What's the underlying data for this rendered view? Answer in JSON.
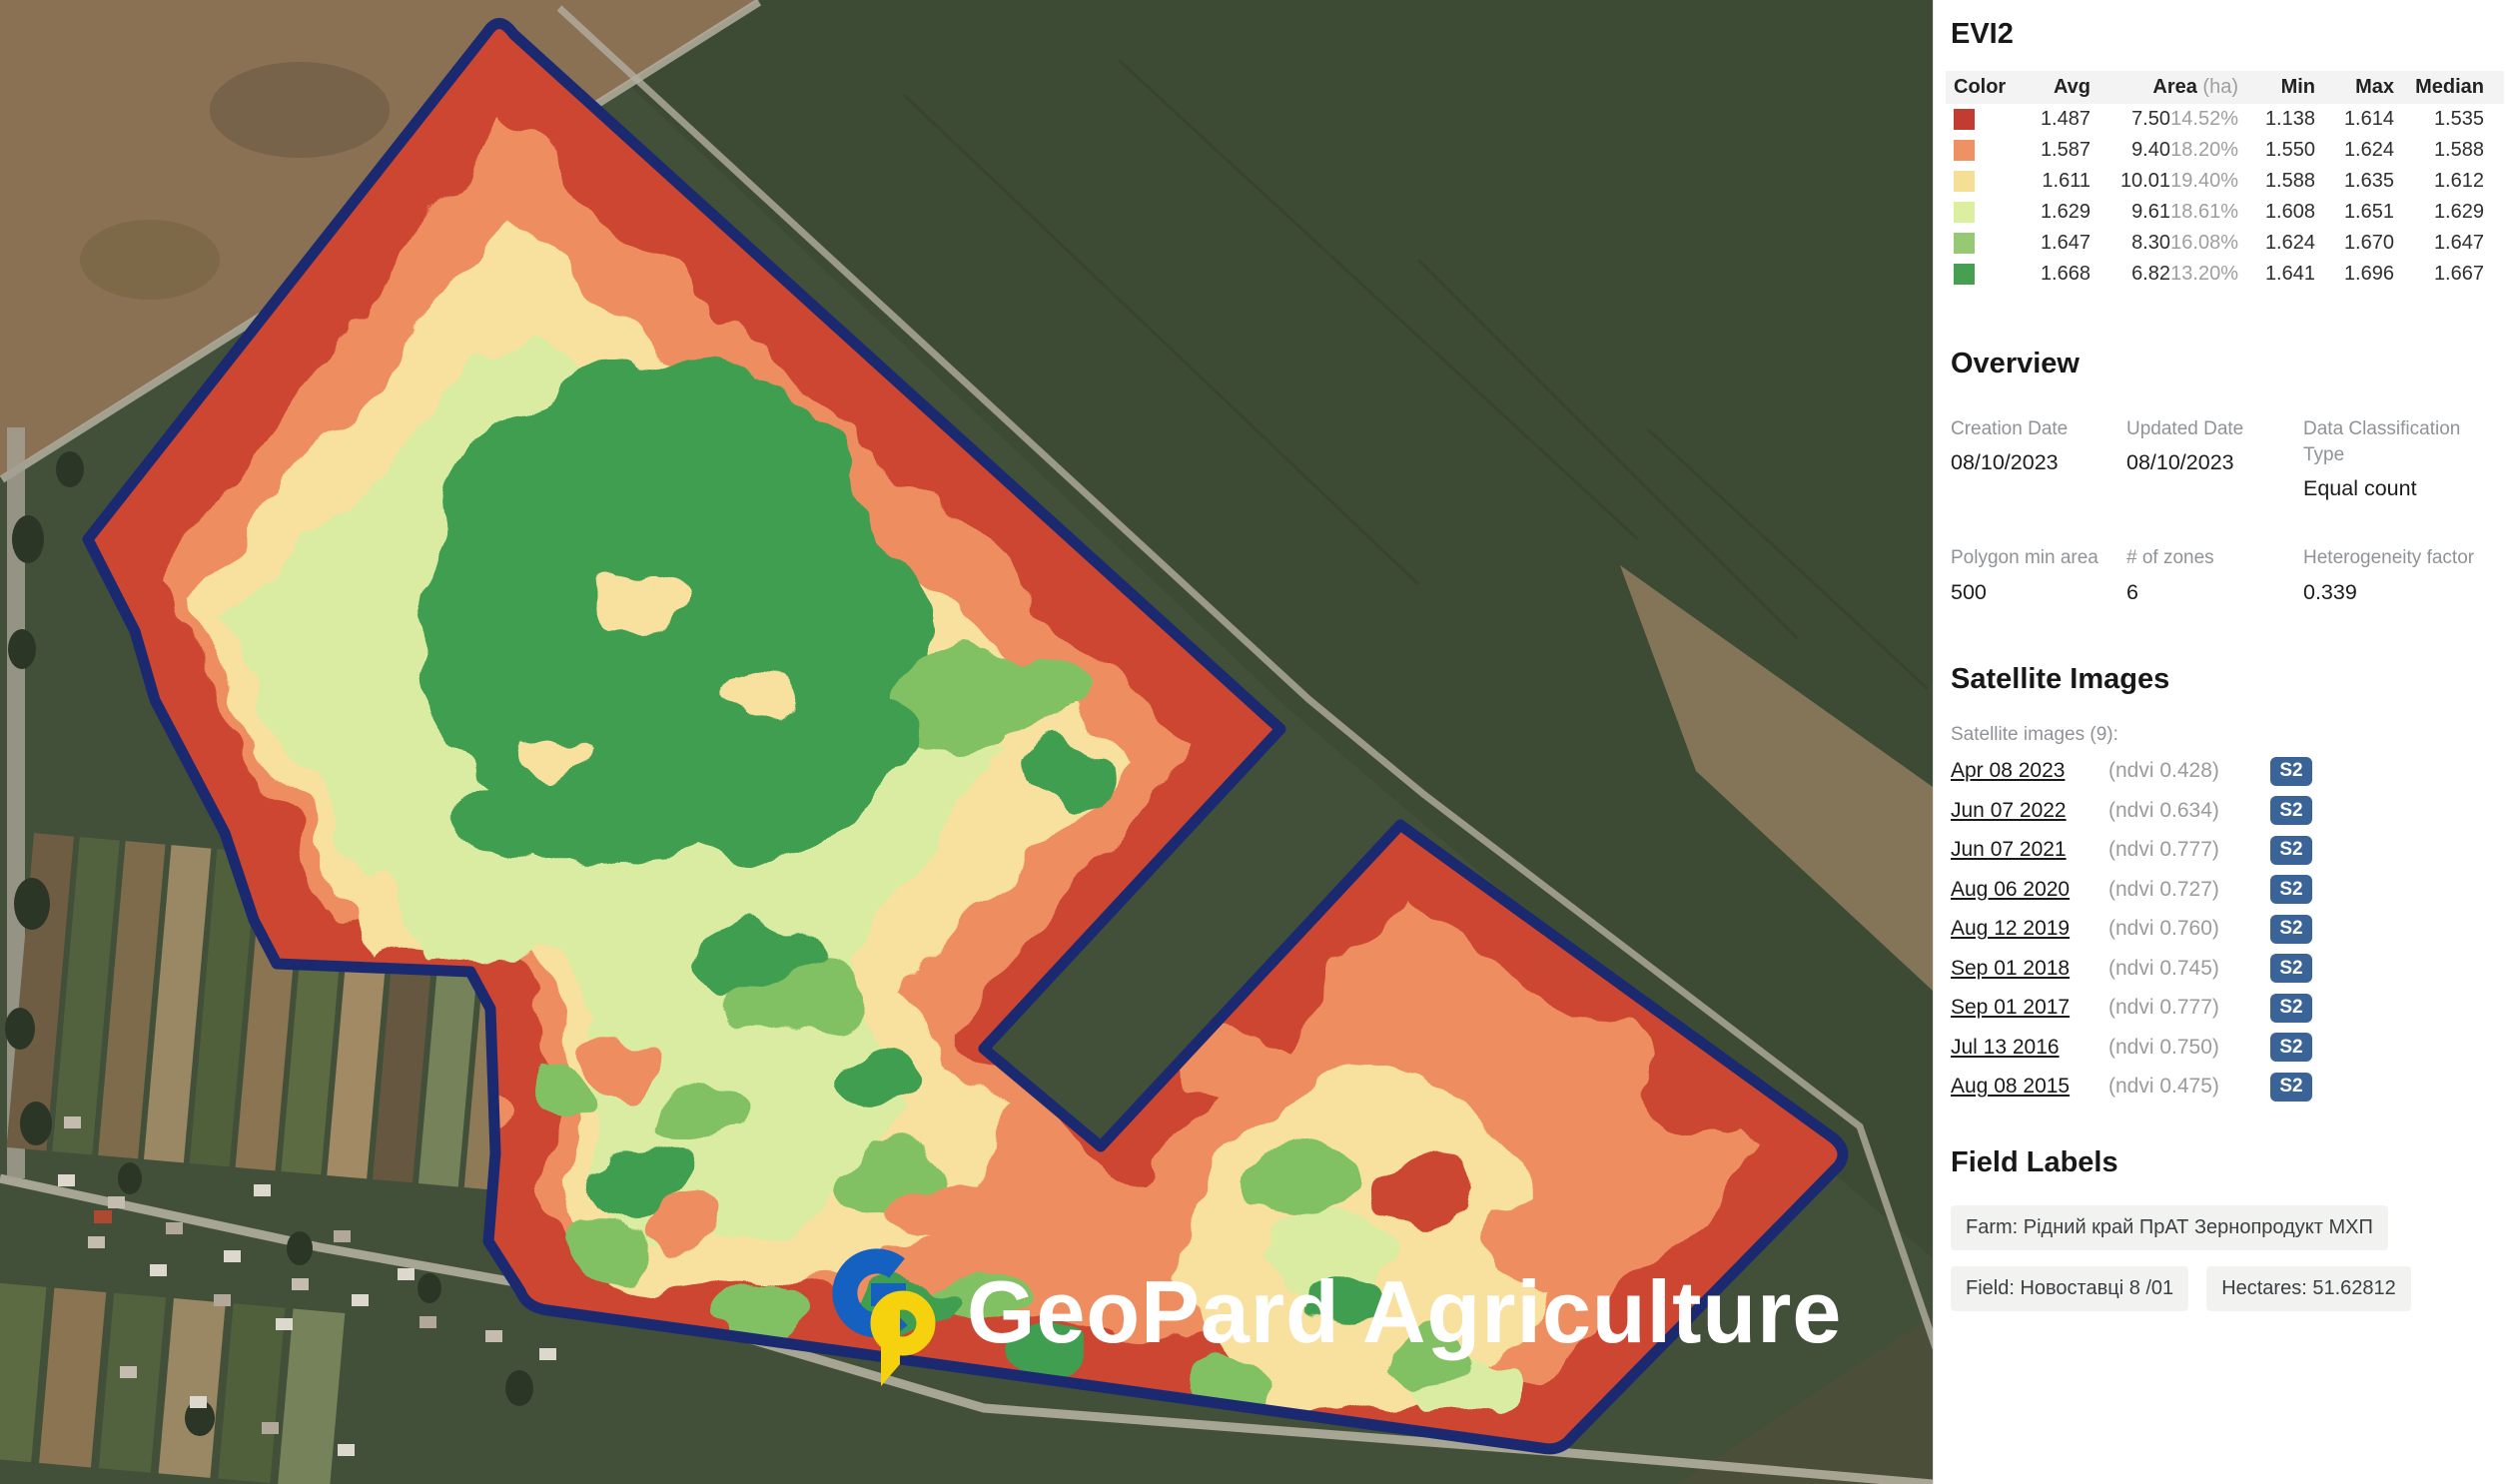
{
  "map": {
    "watermark_text": "GeoPard Agriculture",
    "logo_blue": "#1561c1",
    "logo_yellow": "#f6d20e",
    "field_outline_color": "#1b2a70"
  },
  "evi2": {
    "title": "EVI2",
    "columns": {
      "color": "Color",
      "avg": "Avg",
      "area": "Area",
      "area_unit": "(ha)",
      "min": "Min",
      "max": "Max",
      "median": "Median"
    },
    "rows": [
      {
        "color": "#c23c31",
        "avg": "1.487",
        "area": "7.50",
        "area_pct": "14.52%",
        "min": "1.138",
        "max": "1.614",
        "median": "1.535"
      },
      {
        "color": "#ef9263",
        "avg": "1.587",
        "area": "9.40",
        "area_pct": "18.20%",
        "min": "1.550",
        "max": "1.624",
        "median": "1.588"
      },
      {
        "color": "#f5df94",
        "avg": "1.611",
        "area": "10.01",
        "area_pct": "19.40%",
        "min": "1.588",
        "max": "1.635",
        "median": "1.612"
      },
      {
        "color": "#dcee9f",
        "avg": "1.629",
        "area": "9.61",
        "area_pct": "18.61%",
        "min": "1.608",
        "max": "1.651",
        "median": "1.629"
      },
      {
        "color": "#97c873",
        "avg": "1.647",
        "area": "8.30",
        "area_pct": "16.08%",
        "min": "1.624",
        "max": "1.670",
        "median": "1.647"
      },
      {
        "color": "#47a052",
        "avg": "1.668",
        "area": "6.82",
        "area_pct": "13.20%",
        "min": "1.641",
        "max": "1.696",
        "median": "1.667"
      }
    ]
  },
  "overview": {
    "title": "Overview",
    "fields": [
      {
        "label": "Creation Date",
        "value": "08/10/2023"
      },
      {
        "label": "Updated Date",
        "value": "08/10/2023"
      },
      {
        "label": "Data Classification Type",
        "value": "Equal count"
      },
      {
        "label": "Polygon min area",
        "value": "500"
      },
      {
        "label": "# of zones",
        "value": "6"
      },
      {
        "label": "Heterogeneity factor",
        "value": "0.339"
      }
    ]
  },
  "satellite": {
    "title": "Satellite Images",
    "count_label": "Satellite images (9):",
    "badge": "S2",
    "badge_color": "#3a6398",
    "images": [
      {
        "date": "Apr 08 2023",
        "ndvi": "(ndvi 0.428)"
      },
      {
        "date": "Jun 07 2022",
        "ndvi": "(ndvi 0.634)"
      },
      {
        "date": "Jun 07 2021",
        "ndvi": "(ndvi 0.777)"
      },
      {
        "date": "Aug 06 2020",
        "ndvi": "(ndvi 0.727)"
      },
      {
        "date": "Aug 12 2019",
        "ndvi": "(ndvi 0.760)"
      },
      {
        "date": "Sep 01 2018",
        "ndvi": "(ndvi 0.745)"
      },
      {
        "date": "Sep 01 2017",
        "ndvi": "(ndvi 0.777)"
      },
      {
        "date": "Jul 13 2016",
        "ndvi": "(ndvi 0.750)"
      },
      {
        "date": "Aug 08 2015",
        "ndvi": "(ndvi 0.475)"
      }
    ]
  },
  "field_labels": {
    "title": "Field Labels",
    "farm": "Farm: Рідний край ПрАТ Зернопродукт МХП",
    "field": "Field: Новоставці 8 /01",
    "hectares": "Hectares: 51.62812"
  }
}
